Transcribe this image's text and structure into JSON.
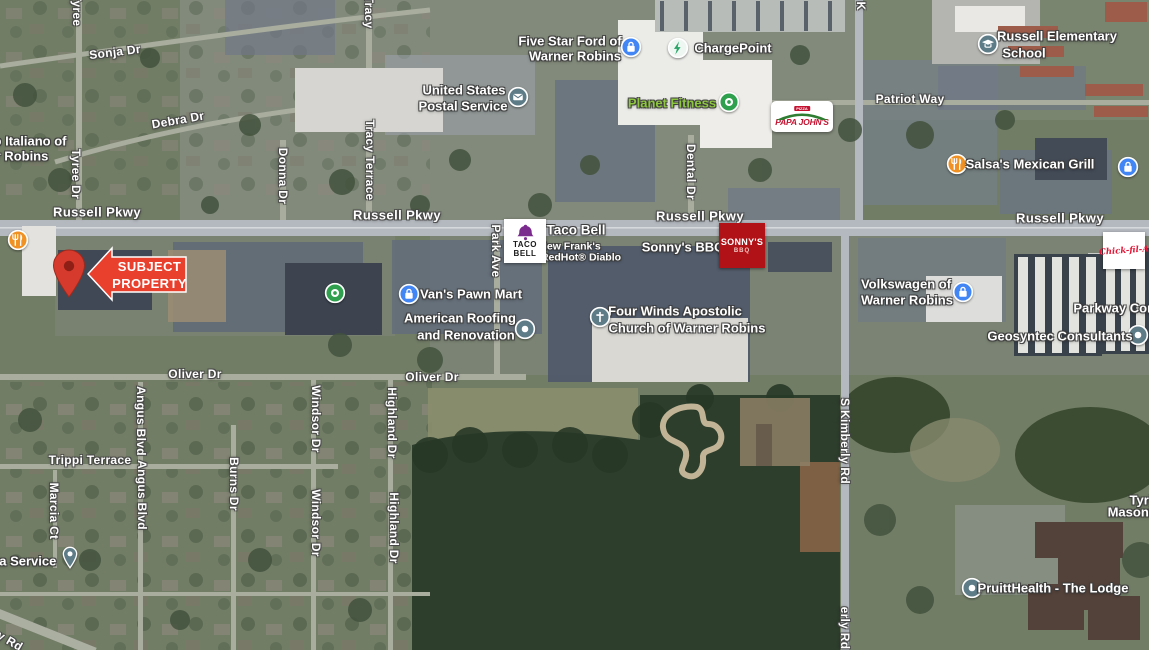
{
  "title": "Aerial map - Russell Pkwy corridor with subject property",
  "colors": {
    "subject_arrow_red": "#e9402e",
    "map_pin_red": "#d63a2c",
    "poi_teal": "#5e7c88",
    "poi_blue": "#4285f4",
    "poi_green": "#2fa04e",
    "poi_orange": "#f09123",
    "charging_green": "#27a566",
    "planet_fitness_green": "#8dc63f",
    "tacobell_purple": "#7b2a8d",
    "sonnys_red": "#b01217",
    "papajohns_red": "#c41230",
    "papajohns_green": "#2e7d32",
    "chickfila_red": "#e51636"
  },
  "subject": {
    "line1": "SUBJECT",
    "line2": "PROPERTY"
  },
  "logos": {
    "taco_bell": {
      "line1": "TACO",
      "line2": "BELL"
    },
    "sonnys": {
      "line1": "SONNY'S",
      "line2": "BBQ"
    },
    "papa_johns": {
      "banner": "PIZZA",
      "name": "PAPA JOHN'S"
    },
    "chick_fil_a": {
      "name": "Chick-fil-A"
    }
  },
  "map": {
    "street_labels": [
      {
        "text": "Tyree",
        "x": 77,
        "y": 10,
        "rot": 90
      },
      {
        "text": "Sonja Dr",
        "x": 115,
        "y": 52,
        "rot": -7
      },
      {
        "text": "Tracy",
        "x": 369,
        "y": 12,
        "rot": 90
      },
      {
        "text": "Debra Dr",
        "x": 178,
        "y": 120,
        "rot": -10
      },
      {
        "text": "Tyree Dr",
        "x": 76,
        "y": 174,
        "rot": 90
      },
      {
        "text": "Donna Dr",
        "x": 283,
        "y": 176,
        "rot": 90
      },
      {
        "text": "Tracy Terrace",
        "x": 370,
        "y": 160,
        "rot": 90
      },
      {
        "text": "Dental Dr",
        "x": 691,
        "y": 172,
        "rot": 90
      },
      {
        "text": "K",
        "x": 861,
        "y": 6,
        "rot": 90
      },
      {
        "text": "Russell Pkwy",
        "x": 97,
        "y": 212,
        "cls": "hwy"
      },
      {
        "text": "Russell Pkwy",
        "x": 397,
        "y": 215,
        "cls": "hwy"
      },
      {
        "text": "Russell Pkwy",
        "x": 700,
        "y": 216,
        "cls": "hwy"
      },
      {
        "text": "Russell Pkwy",
        "x": 1060,
        "y": 218,
        "cls": "hwy"
      },
      {
        "text": "Patriot Way",
        "x": 910,
        "y": 99
      },
      {
        "text": "Park Ave",
        "x": 496,
        "y": 251,
        "rot": 90
      },
      {
        "text": "Oliver Dr",
        "x": 195,
        "y": 374
      },
      {
        "text": "Oliver Dr",
        "x": 432,
        "y": 377
      },
      {
        "text": "S Kimberly Rd",
        "x": 845,
        "y": 441,
        "rot": 90
      },
      {
        "text": "erly Rd",
        "x": 845,
        "y": 628,
        "rot": 90
      },
      {
        "text": "Trippi Terrace",
        "x": 90,
        "y": 460
      },
      {
        "text": "Marcia Ct",
        "x": 54,
        "y": 511,
        "rot": 90
      },
      {
        "text": "Angus Blvd",
        "x": 141,
        "y": 421,
        "rot": 90
      },
      {
        "text": "Angus Blvd",
        "x": 142,
        "y": 495,
        "rot": 90
      },
      {
        "text": "Burns Dr",
        "x": 234,
        "y": 484,
        "rot": 90
      },
      {
        "text": "Windsor Dr",
        "x": 316,
        "y": 419,
        "rot": 90
      },
      {
        "text": "Windsor Dr",
        "x": 316,
        "y": 523,
        "rot": 90
      },
      {
        "text": "Highland Dr",
        "x": 392,
        "y": 423,
        "rot": 90
      },
      {
        "text": "Highland Dr",
        "x": 394,
        "y": 528,
        "rot": 90
      },
      {
        "text": "y Rd",
        "x": 10,
        "y": 641,
        "rot": 30
      }
    ],
    "poi_labels": [
      {
        "text": "o Italiano of",
        "x": 30,
        "y": 141
      },
      {
        "text": "r Robins",
        "x": 22,
        "y": 156
      },
      {
        "text": "United States",
        "x": 464,
        "y": 90
      },
      {
        "text": "Postal Service",
        "x": 463,
        "y": 106,
        "icon": "postal",
        "icon_x": 518,
        "icon_y": 97
      },
      {
        "text": "Five Star Ford of",
        "x": 570,
        "y": 41
      },
      {
        "text": "Warner Robins",
        "x": 575,
        "y": 56,
        "icon": "shopping",
        "icon_x": 631,
        "icon_y": 47
      },
      {
        "text": "ChargePoint",
        "x": 733,
        "y": 48,
        "icon": "charging",
        "icon_x": 678,
        "icon_y": 48
      },
      {
        "text": "Planet Fitness",
        "x": 672,
        "y": 103,
        "cls": "green",
        "icon": "store-green",
        "icon_x": 729,
        "icon_y": 102
      },
      {
        "text": "Russell Elementary",
        "x": 1057,
        "y": 36
      },
      {
        "text": "School",
        "x": 1024,
        "y": 53,
        "icon": "school",
        "icon_x": 988,
        "icon_y": 44
      },
      {
        "text": "Salsa's Mexican Grill",
        "x": 1030,
        "y": 164,
        "icon": "restaurant",
        "icon_x": 957,
        "icon_y": 164
      },
      {
        "icon": "shopping",
        "icon_x": 1128,
        "icon_y": 167
      },
      {
        "text": "Taco Bell",
        "x": 576,
        "y": 230,
        "cls": "big"
      },
      {
        "text": "New Frank's",
        "x": 570,
        "y": 247,
        "cls": "sub"
      },
      {
        "text": "RedHot® Diablo",
        "x": 581,
        "y": 258,
        "cls": "sub"
      },
      {
        "text": "Sonny's BBQ",
        "x": 683,
        "y": 247
      },
      {
        "text": "Van's Pawn Mart",
        "x": 471,
        "y": 294,
        "icon": "pawn",
        "icon_x": 409,
        "icon_y": 294
      },
      {
        "text": "American Roofing",
        "x": 460,
        "y": 318
      },
      {
        "text": "and Renovation",
        "x": 466,
        "y": 335,
        "icon": "dot",
        "icon_x": 525,
        "icon_y": 329
      },
      {
        "text": "Four Winds Apostolic",
        "x": 675,
        "y": 311
      },
      {
        "text": "Church of Warner Robins",
        "x": 687,
        "y": 328,
        "icon": "church",
        "icon_x": 600,
        "icon_y": 317
      },
      {
        "text": "Volkswagen of",
        "x": 906,
        "y": 284
      },
      {
        "text": "Warner Robins",
        "x": 907,
        "y": 300,
        "icon": "pawn",
        "icon_x": 963,
        "icon_y": 292
      },
      {
        "text": "Parkway Com",
        "x": 1116,
        "y": 308
      },
      {
        "text": "Geosyntec Consultants",
        "x": 1060,
        "y": 336,
        "icon": "dot",
        "icon_x": 1138,
        "icon_y": 335
      },
      {
        "icon": "store-green",
        "icon_x": 335,
        "icon_y": 293
      },
      {
        "icon": "restaurant",
        "icon_x": 18,
        "icon_y": 240
      },
      {
        "text": "ia Service",
        "x": 26,
        "y": 561,
        "icon": "pin",
        "icon_x": 70,
        "icon_y": 558
      },
      {
        "text": "PruittHealth - The Lodge",
        "x": 1053,
        "y": 588,
        "icon": "dot",
        "icon_x": 972,
        "icon_y": 588
      },
      {
        "text": "Tyri",
        "x": 1141,
        "y": 500
      },
      {
        "text": "Masoni",
        "x": 1130,
        "y": 512
      }
    ]
  }
}
